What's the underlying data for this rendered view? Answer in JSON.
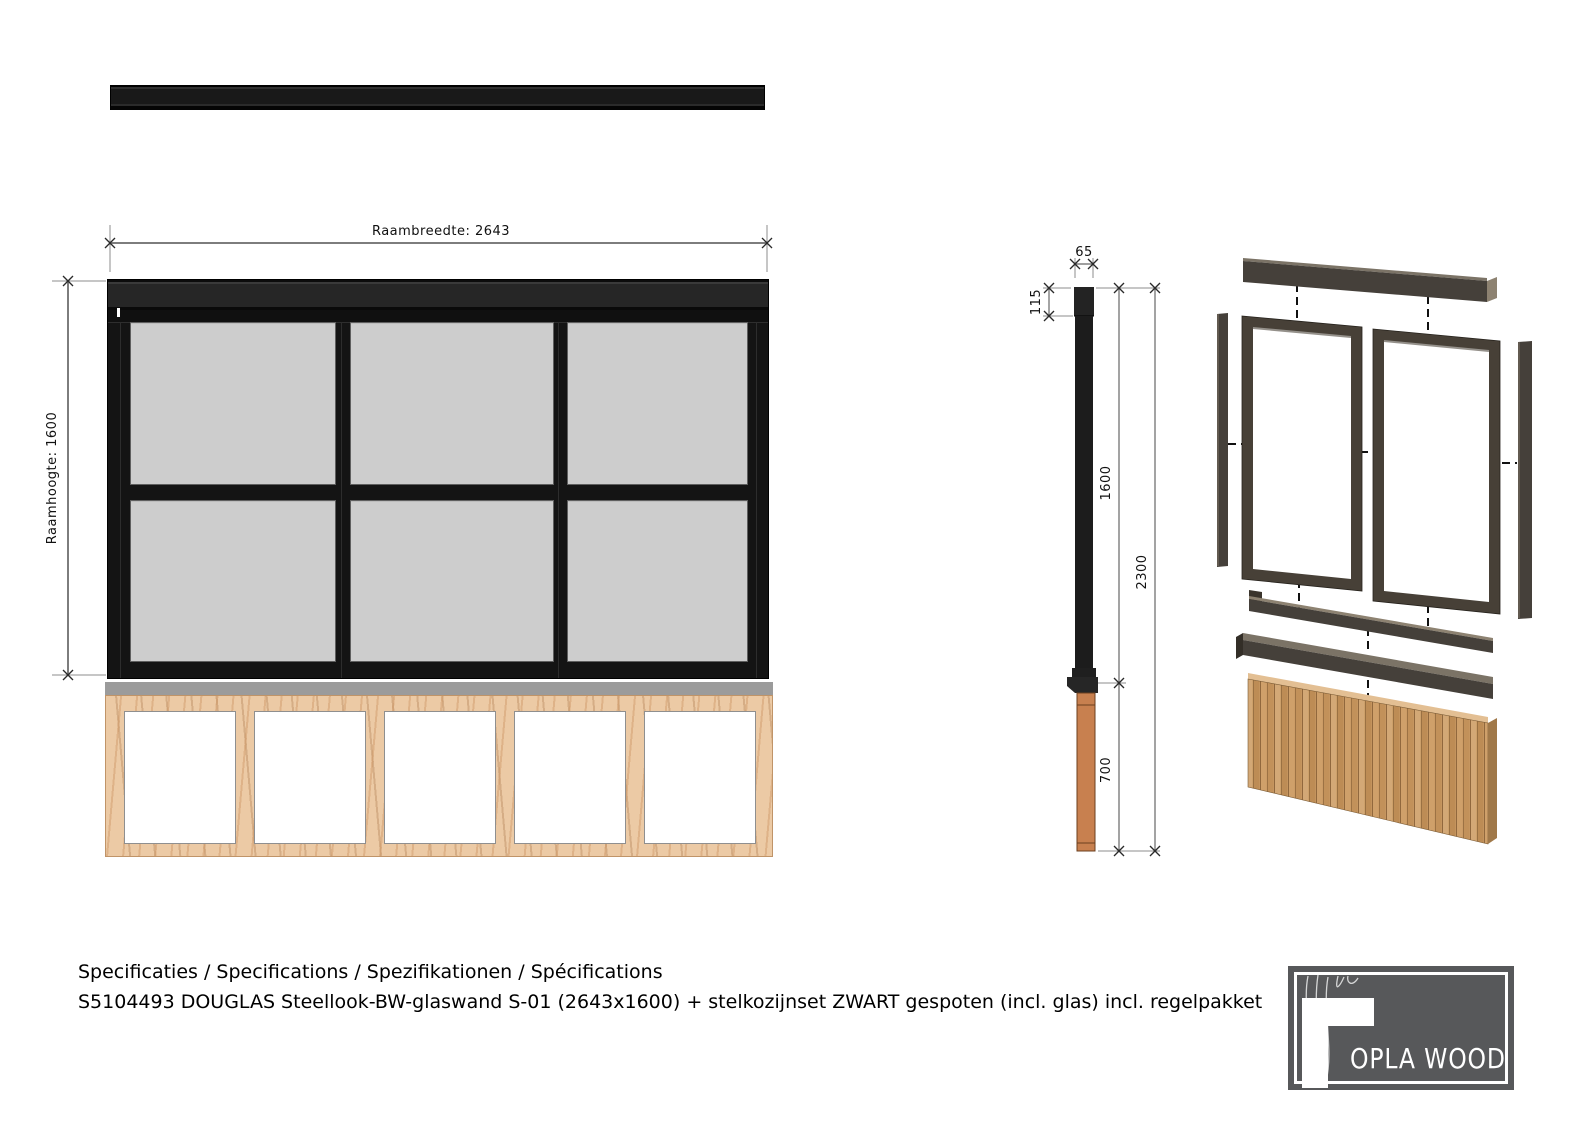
{
  "front_view": {
    "width_dim_label": "Raambreedte: 2643",
    "height_dim_label": "Raamhoogte: 1600",
    "glass_panes": 6,
    "wall_bays": 5
  },
  "side_view": {
    "width_label": "65",
    "head_height_label": "115",
    "frame_height_label": "1600",
    "total_height_label": "2300",
    "base_height_label": "700"
  },
  "footer": {
    "languages_line": "Specificaties / Specifications / Spezifikationen / Spécifications",
    "product_line": "S5104493 DOUGLAS Steellook-BW-glaswand S-01 (2643x1600) + stelkozijnset ZWART gespoten (incl. glas) incl. regelpakket"
  },
  "logo": {
    "brand": "OPLA WOOD"
  },
  "colors": {
    "frame_black": "#1b1b1b",
    "glass_gray": "#cdcdcd",
    "stud_wood": "#eccaa5",
    "post_wood": "#c8804f",
    "slat_wood": "#c99a63",
    "metal_brown": "#45403a",
    "logo_gray": "#57585a",
    "sill_gray": "#9b9b9b"
  }
}
